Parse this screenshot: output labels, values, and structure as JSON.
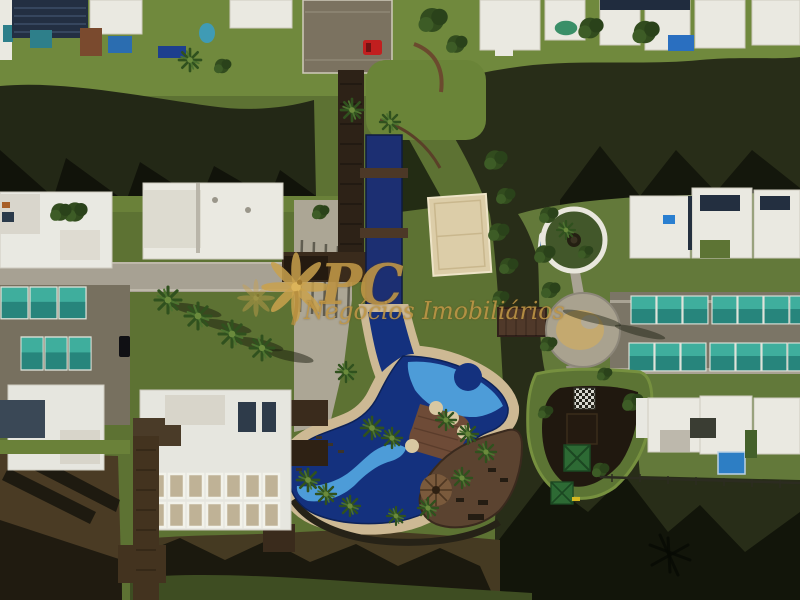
{
  "image": {
    "kind": "aerial-drone-photograph",
    "subject": "Top-down aerial view of a waterfront gated community crossed by dark canals, with a free-form resort pool, lap pool, beach-volleyball court, wooden decks, a palapa hut, covered courts/carports, circular plaza and white modern houses",
    "width_px": 800,
    "height_px": 600
  },
  "watermark": {
    "logo_icon": "palm-tree-logo",
    "brand_initials": "PC",
    "brand_line": "Negócios Imobiliários",
    "gold_color": "#c39a49"
  },
  "palette": {
    "grass": "#5d7233",
    "lawn_bright": "#72893d",
    "water_dark_canal": "#232816",
    "water_brown_canal": "#4a3b24",
    "water_shadow": "#0e100a",
    "concrete_light": "#b0aa9b",
    "asphalt": "#77705f",
    "sand_deck": "#cdb994",
    "court_sand": "#dccda8",
    "pool_navy": "#14317e",
    "pool_light_blue": "#4d9cd8",
    "wood_dark": "#2d2217",
    "wood_red": "#6e4b37",
    "teal_roof": "#2f9a8d",
    "white_roof": "#eae9e1",
    "solar_panel": "#232f42",
    "red_car": "#c11f1f",
    "canopy_green": "#2d6a34",
    "watermark_gold": "#c39a49"
  },
  "scene": {
    "areas": [
      {
        "name": "top-houses-row",
        "note": "row of white-roofed houses with dark solar roofs and small private pools along the upper canal"
      },
      {
        "name": "top-canal",
        "note": "dark canal crossing full width with jagged building shadows"
      },
      {
        "name": "parking-lot",
        "note": "small lot at top center with one red car"
      },
      {
        "name": "footbridge",
        "note": "T-shaped dark wooden walkway crossing the canal to the amenities"
      },
      {
        "name": "lap-pool",
        "note": "narrow navy lap pool crossed by wooden deck bars"
      },
      {
        "name": "beach-volleyball-court",
        "note": "sand court with faint white lines beside the canal"
      },
      {
        "name": "resort-pool",
        "note": "large free-form pool with navy and light-blue wave pattern"
      },
      {
        "name": "sand-deck",
        "note": "tan beach deck with loungers and pergolas around the pool"
      },
      {
        "name": "wood-deck",
        "note": "reddish timber deck crossing the pool and curving along the canal"
      },
      {
        "name": "palapa-hut",
        "note": "round thatched-roof hut on the timber deck"
      },
      {
        "name": "clubhouse-building",
        "note": "large white building with grid of skylights, bottom left"
      },
      {
        "name": "carports-left",
        "note": "two rows of teal-covered structures, left edge"
      },
      {
        "name": "carports-right",
        "note": "two rows of teal-covered structures, right side"
      },
      {
        "name": "circular-garden",
        "note": "white ring planter with trees and dark center"
      },
      {
        "name": "circular-plaza",
        "note": "round concrete plaza with tan mosaic center"
      },
      {
        "name": "canal-bridge-right",
        "note": "small wooden bridge over the right canal"
      },
      {
        "name": "playground-island",
        "note": "peninsula with dark timber playground, green pyramid canopies and a giant chessboard"
      },
      {
        "name": "waterfront-houses-bottom-right",
        "note": "white houses with a blue pool above the lower canal"
      },
      {
        "name": "bottom-canal",
        "note": "brown canal with long roof and palm shadows, grass bank at bottom edge"
      }
    ]
  }
}
